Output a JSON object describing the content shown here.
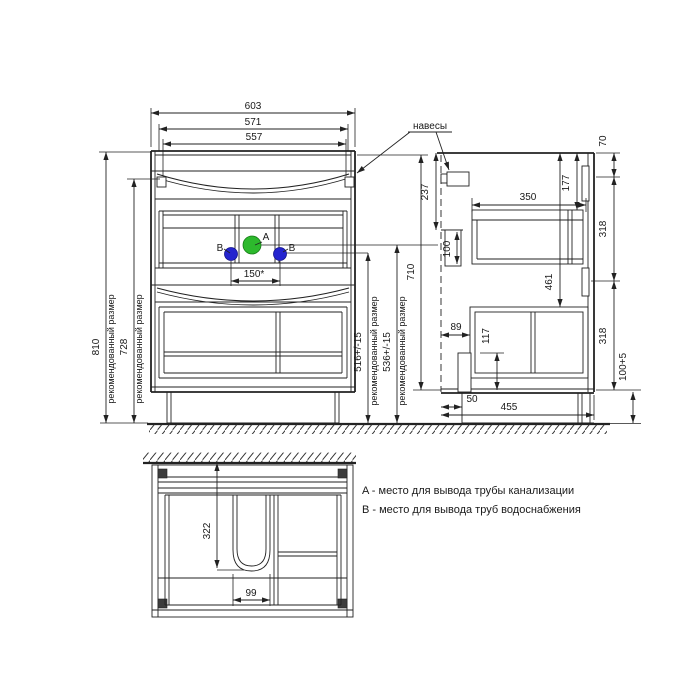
{
  "front_view": {
    "dim_width_overall": "603",
    "dim_width_inner": "571",
    "dim_width_carcass": "557",
    "dim_height_overall": "810",
    "dim_height_worktop": "728",
    "dim_pipe_b_height": "516+/-15",
    "dim_pipe_a_height": "536+/-15",
    "dim_height_body": "710",
    "dim_pipe_spacing": "150*",
    "recommended_label": "рекомендованный размер",
    "point_a_label": "A",
    "point_b_label": "B"
  },
  "side_view": {
    "hinges_label": "навесы",
    "dim_top_rail": "70",
    "dim_hinge_offset": "237",
    "dim_drawer_depth": "350",
    "dim_top_offset": "177",
    "dim_back_upper": "318",
    "dim_rail": "100",
    "dim_drawer2_offset": "461",
    "dim_front_inset": "89",
    "dim_leg": "117",
    "dim_back_lower": "318",
    "dim_plinth": "100+5",
    "dim_toe_kick": "50",
    "dim_depth": "455"
  },
  "bottom_view": {
    "dim_cutout_depth": "322",
    "dim_cutout_width": "99"
  },
  "legend": {
    "line_a": "A - место для вывода трубы канализации",
    "line_b": "B - место для вывода труб водоснабжения"
  },
  "colors": {
    "line": "#222222",
    "point_a": "#2db92d",
    "point_b": "#2424cf"
  }
}
